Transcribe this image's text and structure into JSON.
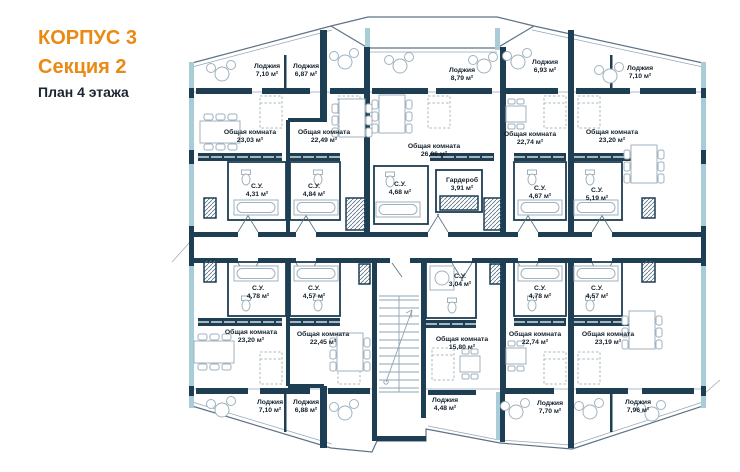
{
  "header": {
    "line1": "КОРПУС 3",
    "line2": "Секция 2",
    "line3": "План 4 этажа"
  },
  "colors": {
    "accent_orange": "#EA8A15",
    "wall_dark": "#1D3E53",
    "wall_light_teal": "#A9CDD6",
    "furniture_gray": "#9FB2BD",
    "label_dark": "#14212D"
  },
  "rooms": [
    {
      "label": "Лоджия",
      "area": "7,10 м²"
    },
    {
      "label": "Лоджия",
      "area": "6,87 м²"
    },
    {
      "label": "Лоджия",
      "area": "8,79 м²"
    },
    {
      "label": "Лоджия",
      "area": "6,93 м²"
    },
    {
      "label": "Лоджия",
      "area": "7,10 м²"
    },
    {
      "label": "Общая комната",
      "area": "23,03 м²"
    },
    {
      "label": "Общая комната",
      "area": "22,49 м²"
    },
    {
      "label": "Общая комната",
      "area": "26,06 м²"
    },
    {
      "label": "Общая комната",
      "area": "22,74 м²"
    },
    {
      "label": "Общая комната",
      "area": "23,20 м²"
    },
    {
      "label": "С.У.",
      "area": "4,31 м²"
    },
    {
      "label": "С.У.",
      "area": "4,84 м²"
    },
    {
      "label": "С.У.",
      "area": "4,68 м²"
    },
    {
      "label": "Гардероб",
      "area": "3,91 м²"
    },
    {
      "label": "С.У.",
      "area": "4,67 м²"
    },
    {
      "label": "С.У.",
      "area": "5,19 м²"
    },
    {
      "label": "С.У.",
      "area": "4,78 м²"
    },
    {
      "label": "С.У.",
      "area": "4,57 м²"
    },
    {
      "label": "С.У.",
      "area": "3,04 м²"
    },
    {
      "label": "С.У.",
      "area": "4,78 м²"
    },
    {
      "label": "С.У.",
      "area": "4,57 м²"
    },
    {
      "label": "Общая комната",
      "area": "23,20 м²"
    },
    {
      "label": "Общая комната",
      "area": "22,45 м²"
    },
    {
      "label": "Общая комната",
      "area": "15,80 м²"
    },
    {
      "label": "Общая комната",
      "area": "22,74 м²"
    },
    {
      "label": "Общая комната",
      "area": "23,19 м²"
    },
    {
      "label": "Лоджия",
      "area": "7,10 м²"
    },
    {
      "label": "Лоджия",
      "area": "6,88 м²"
    },
    {
      "label": "Лоджия",
      "area": "4,48 м²"
    },
    {
      "label": "Лоджия",
      "area": "7,70 м²"
    },
    {
      "label": "Лоджия",
      "area": "7,96 м²"
    }
  ]
}
